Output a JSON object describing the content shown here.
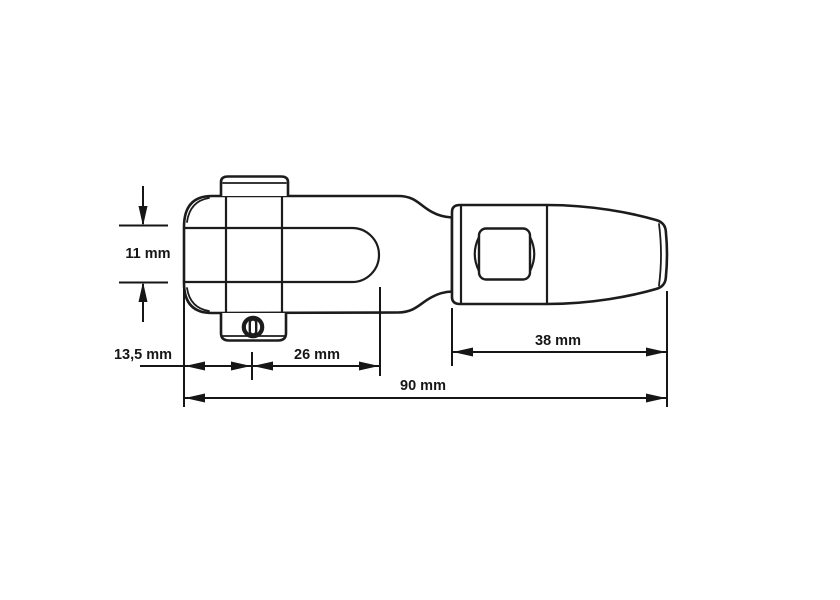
{
  "drawing": {
    "type": "technical-dimension-drawing",
    "subject": "fork terminal swage fitting, side view",
    "background": "#ffffff",
    "line_color": "#1c1c1c",
    "dimensions": {
      "jaw_height": {
        "label": "11 mm",
        "value": 11,
        "unit": "mm",
        "orientation": "vertical"
      },
      "pin_offset": {
        "label": "13,5 mm",
        "value": 13.5,
        "unit": "mm",
        "orientation": "horizontal"
      },
      "slot_depth": {
        "label": "26 mm",
        "value": 26,
        "unit": "mm",
        "orientation": "horizontal"
      },
      "body_length": {
        "label": "38 mm",
        "value": 38,
        "unit": "mm",
        "orientation": "horizontal"
      },
      "overall_length": {
        "label": "90 mm",
        "value": 90,
        "unit": "mm",
        "orientation": "horizontal"
      }
    }
  }
}
